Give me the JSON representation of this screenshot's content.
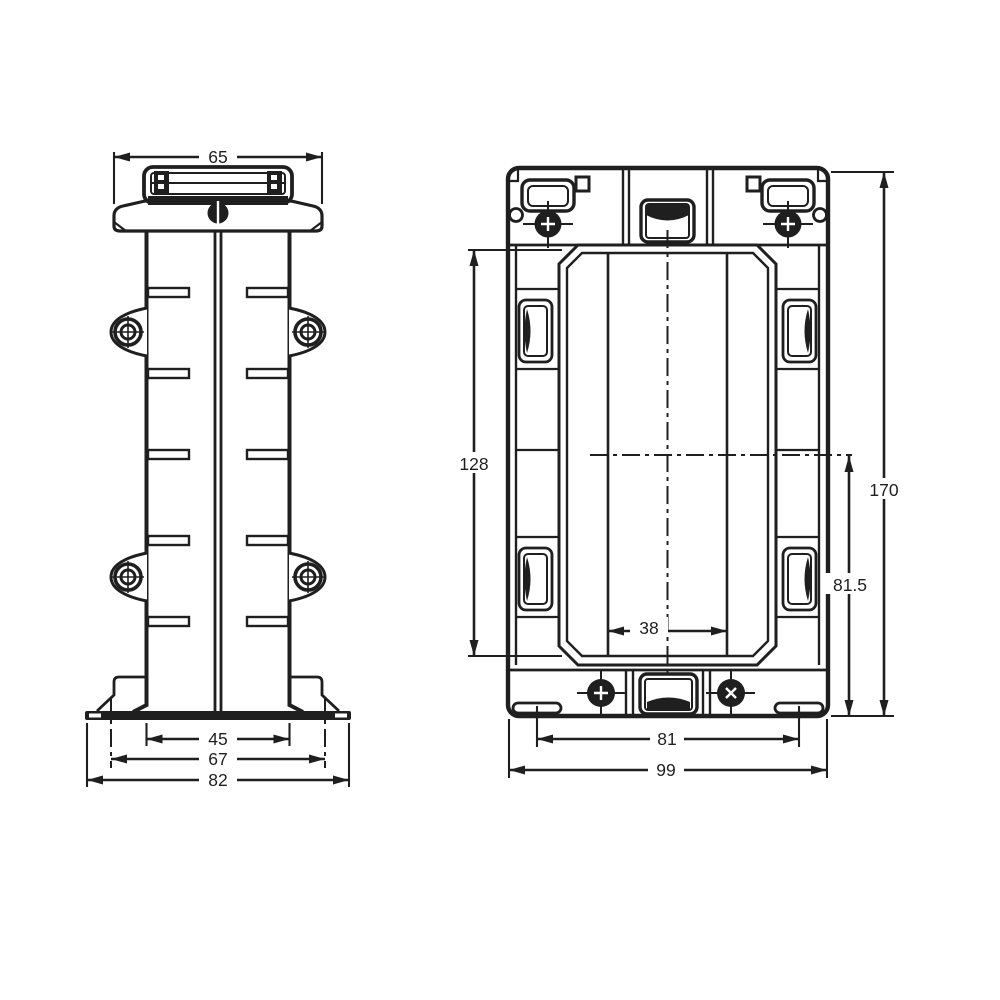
{
  "drawing": {
    "type": "technical-dimension-drawing",
    "background": "#ffffff",
    "line_color": "#1f1f1f",
    "units_shown": "mm (numeric only)",
    "side_view": {
      "name": "side-view",
      "dims": [
        {
          "id": "dim-65",
          "label": "65",
          "orientation": "horizontal",
          "position": "top"
        },
        {
          "id": "dim-45",
          "label": "45",
          "orientation": "horizontal",
          "position": "bottom"
        },
        {
          "id": "dim-67",
          "label": "67",
          "orientation": "horizontal",
          "position": "bottom"
        },
        {
          "id": "dim-82",
          "label": "82",
          "orientation": "horizontal",
          "position": "bottom"
        }
      ]
    },
    "front_view": {
      "name": "front-view",
      "dims": [
        {
          "id": "dim-128",
          "label": "128",
          "orientation": "vertical",
          "position": "left"
        },
        {
          "id": "dim-170",
          "label": "170",
          "orientation": "vertical",
          "position": "right"
        },
        {
          "id": "dim-81-5",
          "label": "81.5",
          "orientation": "vertical",
          "position": "right-inner"
        },
        {
          "id": "dim-38",
          "label": "38",
          "orientation": "horizontal",
          "position": "center"
        },
        {
          "id": "dim-81",
          "label": "81",
          "orientation": "horizontal",
          "position": "bottom"
        },
        {
          "id": "dim-99",
          "label": "99",
          "orientation": "horizontal",
          "position": "bottom"
        }
      ]
    }
  }
}
